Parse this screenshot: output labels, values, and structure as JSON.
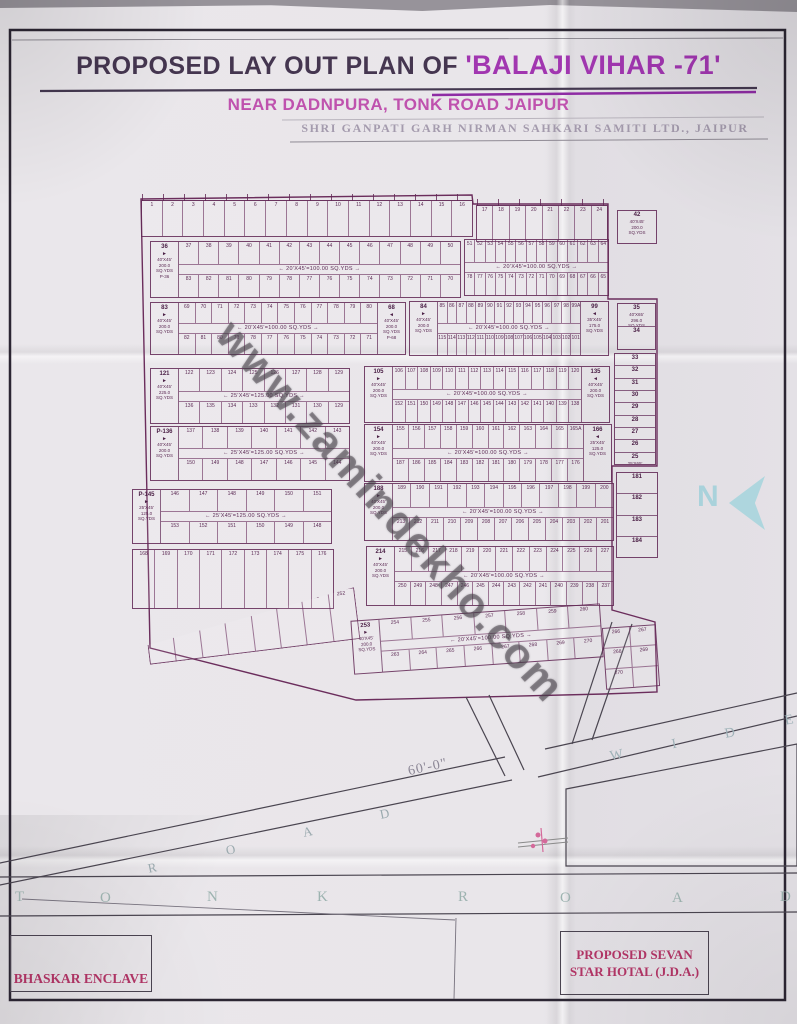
{
  "title": {
    "prefix": "PROPOSED LAY OUT PLAN OF ",
    "highlight": "'BALAJI VIHAR -71'"
  },
  "subtitle": "NEAR DADNPURA, TONK ROAD JAIPUR",
  "society": "SHRI GANPATI GARH NIRMAN SAHKARI SAMITI LTD.,  JAIPUR",
  "watermark": "www.zamindekho.com",
  "north_label": "N",
  "labels": {
    "bhaskar": "BHASKAR ENCLAVE",
    "hotel_line1": "PROPOSED SEVAN",
    "hotel_line2": "STAR HOTAL (J.D.A.)",
    "road_width": "60'-0\""
  },
  "colors": {
    "title_dark": "#453650",
    "title_highlight": "#a136b0",
    "subtitle_magenta": "#bf52ae",
    "plan_line_purple": "#60264f",
    "label_pink": "#b23566",
    "north_blue": "#aed6de",
    "road_letter_teal": "#9db3b0",
    "paper": "#e9e6ea"
  },
  "map": {
    "roads": [
      {
        "name": "tonk-road-horizontal",
        "rot": 0,
        "size": 15,
        "color": "#9db3b0",
        "letters": [
          {
            "ch": "T",
            "x": 15,
            "y": 889
          },
          {
            "ch": "O",
            "x": 100,
            "y": 890
          },
          {
            "ch": "N",
            "x": 207,
            "y": 889
          },
          {
            "ch": "K",
            "x": 317,
            "y": 889
          },
          {
            "ch": "R",
            "x": 458,
            "y": 889
          },
          {
            "ch": "O",
            "x": 560,
            "y": 890
          },
          {
            "ch": "A",
            "x": 672,
            "y": 890
          },
          {
            "ch": "D",
            "x": 780,
            "y": 889
          }
        ]
      },
      {
        "name": "road-diagonal-left",
        "rot": -12,
        "size": 13,
        "color": "#9aa9ae",
        "letters": [
          {
            "ch": "R",
            "x": 148,
            "y": 860
          },
          {
            "ch": "O",
            "x": 226,
            "y": 842
          },
          {
            "ch": "A",
            "x": 303,
            "y": 824
          },
          {
            "ch": "D",
            "x": 380,
            "y": 806
          }
        ]
      },
      {
        "name": "road-wide",
        "rot": -11,
        "size": 14,
        "color": "#9fb2b8",
        "letters": [
          {
            "ch": "W",
            "x": 610,
            "y": 748
          },
          {
            "ch": "I",
            "x": 672,
            "y": 737
          },
          {
            "ch": "D",
            "x": 725,
            "y": 726
          },
          {
            "ch": "E",
            "x": 785,
            "y": 713
          }
        ]
      }
    ],
    "blocks": [
      {
        "name": "north-strip-a",
        "x": 141,
        "y": 200,
        "w": 332,
        "h": 37,
        "ticks": true,
        "single": {
          "start": 1,
          "count": 16,
          "dir": 1
        }
      },
      {
        "name": "north-strip-b",
        "x": 476,
        "y": 205,
        "w": 132,
        "h": 37,
        "ticks": true,
        "single": {
          "start": 17,
          "count": 8,
          "dir": 1
        }
      },
      {
        "name": "ne-box",
        "x": 617,
        "y": 210,
        "w": 40,
        "h": 34,
        "vcells": [
          {
            "num": "42",
            "lines": [
              "40'X45'",
              "200.0",
              "SQ.YDS"
            ]
          }
        ]
      },
      {
        "name": "strip1-left",
        "x": 150,
        "y": 241,
        "w": 311,
        "h": 57,
        "left": {
          "num": "36",
          "lines": [
            "40'X45'",
            "200.0",
            "SQ.YDS",
            "P-36"
          ]
        },
        "top": {
          "start": 37,
          "count": 14,
          "dir": 1
        },
        "center": "← 20'X45'=100.00 SQ.YDS →",
        "bottom": {
          "start": 83,
          "count": 14,
          "dir": -1
        }
      },
      {
        "name": "strip1-right",
        "x": 464,
        "y": 239,
        "w": 145,
        "h": 57,
        "top": {
          "start": 51,
          "count": 14,
          "dir": 1
        },
        "center": "← 20'X45'=100.00 SQ.YDS →",
        "bottom": {
          "start": 78,
          "count": 14,
          "dir": -1
        }
      },
      {
        "name": "strip2-left",
        "x": 150,
        "y": 302,
        "w": 256,
        "h": 53,
        "left": {
          "num": "83",
          "lines": [
            "40'X45'",
            "200.0",
            "SQ.YDS"
          ]
        },
        "top": {
          "start": 69,
          "count": 12,
          "dir": 1
        },
        "center": "← 20'X45'=100.00 SQ.YDS →",
        "bottom": {
          "start": 82,
          "count": 12,
          "dir": -1
        },
        "right": {
          "num": "68",
          "lines": [
            "40'X45'",
            "200.0",
            "SQ.YDS",
            "P-68"
          ]
        }
      },
      {
        "name": "strip2-right",
        "x": 409,
        "y": 301,
        "w": 200,
        "h": 55,
        "left": {
          "num": "84",
          "lines": [
            "40'X45'",
            "200.0",
            "SQ.YDS"
          ]
        },
        "top": {
          "start": 85,
          "count": 14,
          "dir": 1,
          "tail": [
            "99A"
          ]
        },
        "center": "← 20'X45'=100.00 SQ.YDS →",
        "bottom": {
          "start": 115,
          "count": 15,
          "dir": -1
        },
        "right": {
          "num": "99",
          "lines": [
            "35'X45'",
            "175.0",
            "SQ.YDS"
          ]
        }
      },
      {
        "name": "right-col-a",
        "x": 617,
        "y": 303,
        "w": 39,
        "h": 47,
        "vcells": [
          {
            "num": "35",
            "lines": [
              "40'X65'",
              "296.0",
              "SQ.YDS"
            ]
          },
          {
            "num": "34"
          }
        ]
      },
      {
        "name": "right-col-b",
        "x": 614,
        "y": 353,
        "w": 42,
        "h": 112,
        "vcells": [
          {
            "num": "33"
          },
          {
            "num": "32"
          },
          {
            "num": "31"
          },
          {
            "num": "30"
          },
          {
            "num": "29"
          },
          {
            "num": "28"
          },
          {
            "num": "27"
          },
          {
            "num": "26"
          },
          {
            "num": "25",
            "lines": [
              "25'X65'",
              "232.7",
              "SQ.YDS"
            ]
          }
        ]
      },
      {
        "name": "strip3-left",
        "x": 150,
        "y": 368,
        "w": 200,
        "h": 56,
        "left": {
          "num": "121",
          "lines": [
            "40'X45'",
            "225.0",
            "SQ.YDS"
          ]
        },
        "top": {
          "start": 122,
          "count": 8,
          "dir": 1
        },
        "center": "← 25'X45'=125.00 SQ.YDS →",
        "bottom": {
          "start": 136,
          "count": 8,
          "dir": -1
        }
      },
      {
        "name": "strip3-right",
        "x": 364,
        "y": 366,
        "w": 246,
        "h": 57,
        "left": {
          "num": "105",
          "lines": [
            "40'X45'",
            "200.0",
            "SQ.YDS"
          ]
        },
        "top": {
          "start": 106,
          "count": 15,
          "dir": 1
        },
        "center": "← 20'X45'=100.00 SQ.YDS →",
        "bottom": {
          "start": 152,
          "count": 15,
          "dir": -1
        },
        "right": {
          "num": "135",
          "lines": [
            "40'X45'",
            "200.0",
            "SQ.YDS"
          ]
        }
      },
      {
        "name": "strip4-left",
        "x": 150,
        "y": 426,
        "w": 200,
        "h": 55,
        "left": {
          "num": "P-136",
          "lines": [
            "40'X45'",
            "200.0",
            "SQ.YDS"
          ]
        },
        "top": {
          "start": 137,
          "count": 7,
          "dir": 1
        },
        "center": "← 25'X45'=125.00 SQ.YDS →",
        "bottom": {
          "start": 150,
          "count": 7,
          "dir": -1
        }
      },
      {
        "name": "strip4-right",
        "x": 364,
        "y": 424,
        "w": 248,
        "h": 58,
        "left": {
          "num": "154",
          "lines": [
            "40'X45'",
            "200.0",
            "SQ.YDS"
          ]
        },
        "top": {
          "start": 155,
          "count": 11,
          "dir": 1,
          "tail": [
            "165A"
          ]
        },
        "center": "← 20'X45'=100.00 SQ.YDS →",
        "bottom": {
          "start": 187,
          "count": 12,
          "dir": -1
        },
        "right": {
          "num": "166",
          "lines": [
            "25'X45'",
            "125.0",
            "SQ.YDS"
          ]
        }
      },
      {
        "name": "strip5-left",
        "x": 132,
        "y": 489,
        "w": 200,
        "h": 55,
        "left": {
          "num": "P-145",
          "lines": [
            "25'X45'",
            "125.0",
            "SQ.YDS"
          ]
        },
        "top": {
          "start": 146,
          "count": 6,
          "dir": 1
        },
        "center": "← 25'X45'=125.00 SQ.YDS →",
        "bottom": {
          "start": 153,
          "count": 6,
          "dir": -1
        }
      },
      {
        "name": "strip5-right",
        "x": 364,
        "y": 483,
        "w": 250,
        "h": 58,
        "left": {
          "num": "188",
          "lines": [
            "40'X45'",
            "200.0",
            "SQ.YDS"
          ]
        },
        "top": {
          "start": 189,
          "count": 12,
          "dir": 1
        },
        "center": "← 20'X45'=100.00 SQ.YDS →",
        "bottom": {
          "start": 213,
          "count": 13,
          "dir": -1
        }
      },
      {
        "name": "right-col-c",
        "x": 616,
        "y": 472,
        "w": 42,
        "h": 86,
        "vcells": [
          {
            "num": "181"
          },
          {
            "num": "182"
          },
          {
            "num": "183"
          },
          {
            "num": "184"
          }
        ]
      },
      {
        "name": "strip6-left",
        "x": 132,
        "y": 549,
        "w": 202,
        "h": 60,
        "single": {
          "start": 168,
          "count": 9,
          "dir": 1
        }
      },
      {
        "name": "strip6-right",
        "x": 366,
        "y": 546,
        "w": 248,
        "h": 60,
        "left": {
          "num": "214",
          "lines": [
            "40'X45'",
            "200.0",
            "SQ.YDS"
          ]
        },
        "top": {
          "start": 215,
          "count": 13,
          "dir": 1
        },
        "center": "← 20'X45'=100.00 SQ.YDS →",
        "bottom": {
          "start": 250,
          "count": 14,
          "dir": -1
        }
      },
      {
        "name": "strip7-tail",
        "x": 146,
        "y": 600,
        "w": 212,
        "h": 52,
        "rot": -7,
        "clip": "polygon(0 62%, 100% 0, 100% 100%, 0 100%)",
        "single": {
          "start": 245,
          "count": 8,
          "dir": 1
        }
      },
      {
        "name": "strip7-main",
        "x": 352,
        "y": 612,
        "w": 250,
        "h": 54,
        "rot": -4,
        "left": {
          "num": "253",
          "lines": [
            "40'X45'",
            "200.0",
            "SQ.YDS"
          ]
        },
        "top": {
          "start": 254,
          "count": 7,
          "dir": 1
        },
        "center": "← 20'X45'=100.00 SQ.YDS →",
        "bottom": {
          "start": 263,
          "count": 8,
          "dir": 1
        }
      },
      {
        "name": "strip7-end",
        "x": 604,
        "y": 626,
        "w": 54,
        "h": 62,
        "rot": -4,
        "grid": [
          [
            "266",
            "267"
          ],
          [
            "268",
            "269"
          ],
          [
            "270",
            ""
          ]
        ]
      }
    ]
  }
}
